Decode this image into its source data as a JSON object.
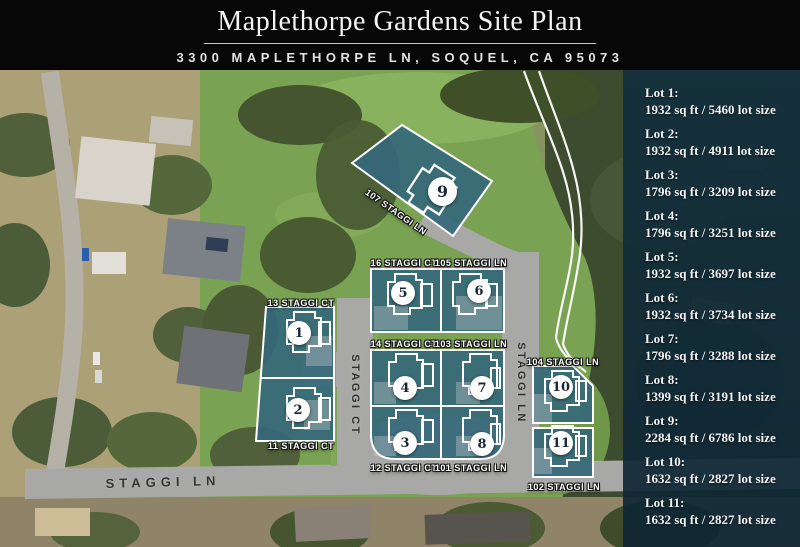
{
  "header": {
    "title": "Maplethorpe Gardens Site Plan",
    "subtitle": "3300 MAPLETHORPE LN, SOQUEL, CA 95073"
  },
  "sidebar": {
    "lots": [
      {
        "label": "Lot 1:",
        "size": "1932 sq ft / 5460 lot size"
      },
      {
        "label": "Lot 2:",
        "size": "1932 sq ft / 4911 lot size"
      },
      {
        "label": "Lot 3:",
        "size": "1796 sq ft / 3209 lot size"
      },
      {
        "label": "Lot 4:",
        "size": "1796 sq ft / 3251 lot size"
      },
      {
        "label": "Lot 5:",
        "size": "1932 sq ft / 3697 lot size"
      },
      {
        "label": "Lot 6:",
        "size": "1932 sq ft / 3734 lot size"
      },
      {
        "label": "Lot 7:",
        "size": "1796 sq ft / 3288 lot size"
      },
      {
        "label": "Lot 8:",
        "size": "1399 sq ft / 3191 lot size"
      },
      {
        "label": "Lot 9:",
        "size": "2284 sq ft / 6786 lot size"
      },
      {
        "label": "Lot 10:",
        "size": "1632 sq ft / 2827 lot size"
      },
      {
        "label": "Lot 11:",
        "size": "1632 sq ft / 2827 lot size"
      }
    ]
  },
  "map": {
    "streets": {
      "bottom": "STAGGI LN",
      "court": "STAGGI CT",
      "lane": "STAGGI LN"
    },
    "parcels": [
      {
        "number": "1",
        "address": "13 STAGGI CT"
      },
      {
        "number": "2",
        "address": "11 STAGGI CT"
      },
      {
        "number": "3",
        "address": "12 STAGGI CT"
      },
      {
        "number": "4",
        "address": "14 STAGGI CT"
      },
      {
        "number": "5",
        "address": "16 STAGGI CT"
      },
      {
        "number": "6",
        "address": "105 STAGGI LN"
      },
      {
        "number": "7",
        "address": "103 STAGGI LN"
      },
      {
        "number": "8",
        "address": "101 STAGGI LN"
      },
      {
        "number": "9",
        "address": "107 STAGGI LN"
      },
      {
        "number": "10",
        "address": "104 STAGGI LN"
      },
      {
        "number": "11",
        "address": "102 STAGGI LN"
      }
    ]
  },
  "colors": {
    "parcel_fill": "#35687a",
    "sidebar_overlay": "#143341",
    "header_bg": "#070707",
    "road_gray": "#a8a8a6",
    "grass_green": "#79a352"
  }
}
